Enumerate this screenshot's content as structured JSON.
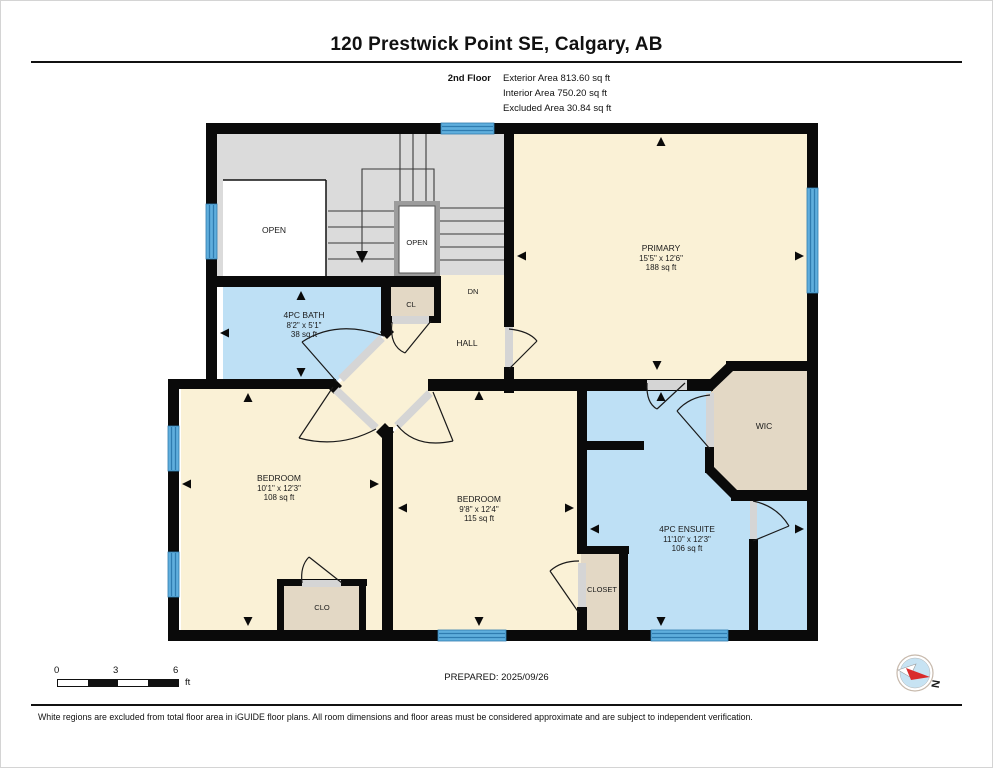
{
  "header": {
    "title": "120 Prestwick Point SE, Calgary, AB",
    "floor_label": "2nd Floor",
    "areas": [
      "Exterior Area 813.60 sq ft",
      "Interior Area 750.20 sq ft",
      "Excluded Area 30.84 sq ft"
    ]
  },
  "plan": {
    "rooms": {
      "primary": {
        "name": "PRIMARY",
        "dims": "15'5\" x 12'6\"",
        "area": "188 sq ft"
      },
      "bath": {
        "name": "4PC BATH",
        "dims": "8'2\" x 5'1\"",
        "area": "38 sq ft"
      },
      "bedroom_left": {
        "name": "BEDROOM",
        "dims": "10'1\" x 12'3\"",
        "area": "108 sq ft"
      },
      "bedroom_middle": {
        "name": "BEDROOM",
        "dims": "9'8\" x 12'4\"",
        "area": "115 sq ft"
      },
      "ensuite": {
        "name": "4PC ENSUITE",
        "dims": "11'10\" x 12'3\"",
        "area": "106 sq ft"
      },
      "wic": {
        "name": "WIC"
      },
      "hall": {
        "name": "HALL"
      },
      "stairs_down": {
        "name": "DN"
      },
      "cl": {
        "name": "CL"
      },
      "clo": {
        "name": "CLO"
      },
      "closet": {
        "name": "CLOSET"
      },
      "open_left": {
        "name": "OPEN"
      },
      "open_stairwell": {
        "name": "OPEN"
      }
    },
    "colors": {
      "room_cream": "#FAF1D6",
      "room_blue": "#BEE0F5",
      "closet_tan": "#E3D8C5",
      "stairs_gray": "#DBDBDB",
      "wall_black": "#0A0A0A",
      "window_blue": "#5FAEDD",
      "window_stripe": "#2F7CB0",
      "door_threshold_gray": "#D5D5D5",
      "compass_red": "#D92B2B",
      "compass_blue": "#C7E3F3"
    }
  },
  "scalebar": {
    "labels": [
      "0",
      "3",
      "6"
    ],
    "unit": "ft"
  },
  "prepared_label": "PREPARED: 2025/09/26",
  "compass": {
    "north_label": "N"
  },
  "disclaimer": "White regions are excluded from total floor area in iGUIDE floor plans. All room dimensions and floor areas must be considered approximate and are subject to independent verification."
}
